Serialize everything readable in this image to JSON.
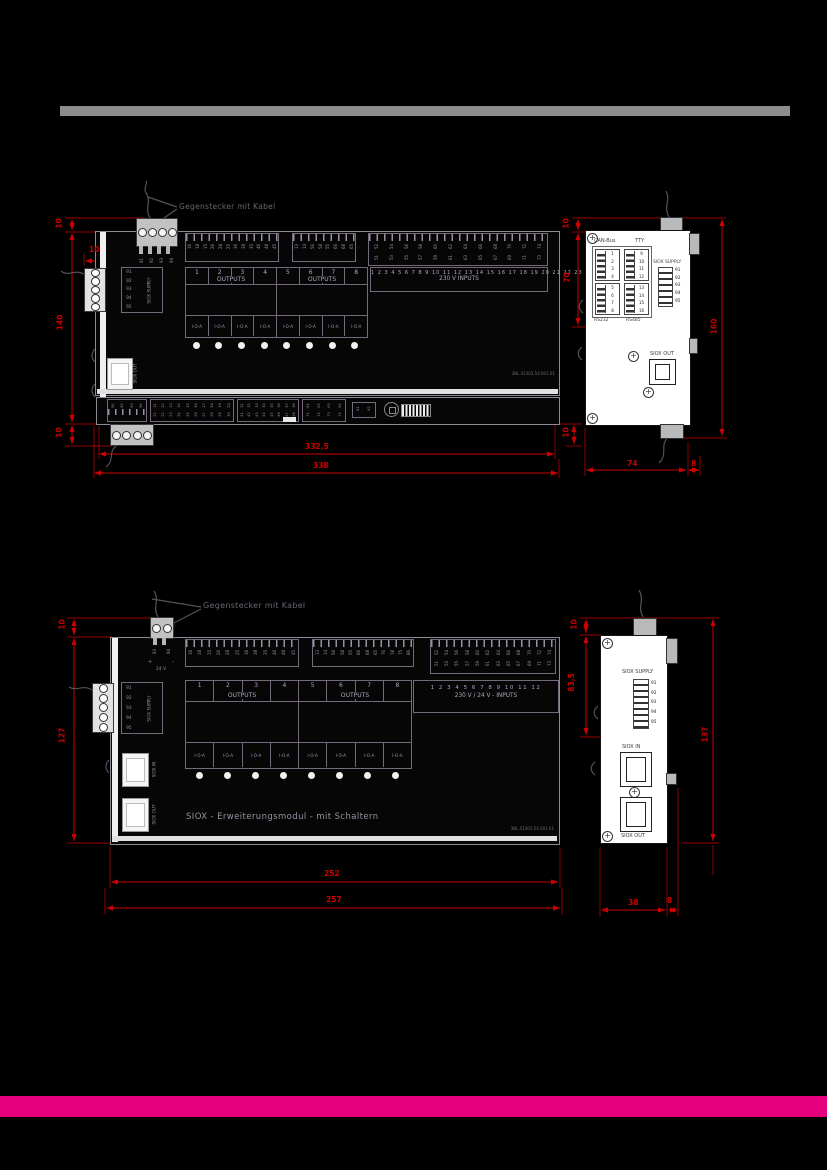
{
  "page": {
    "colors": {
      "background": "#000000",
      "gray_bar": "#8c8c8c",
      "magenta_bar": "#e6007e",
      "dimension_red": "#cc0000"
    }
  },
  "annotation": {
    "label": "Gegenstecker mit Kabel"
  },
  "module1": {
    "front": {
      "top_connector_pins": [
        "91",
        "92",
        "93",
        "94"
      ],
      "strip1_numbers": [
        "16",
        "18",
        "15",
        "26",
        "28",
        "25",
        "36",
        "38",
        "35",
        "46",
        "48",
        "45"
      ],
      "strip2_numbers": [
        "13",
        "14",
        "56",
        "58",
        "55",
        "66",
        "68",
        "65"
      ],
      "strip3_top": [
        "52",
        "54",
        "56",
        "58",
        "60",
        "62",
        "64",
        "66",
        "68",
        "70",
        "72",
        "74"
      ],
      "strip3_bottom": [
        "51",
        "53",
        "55",
        "57",
        "59",
        "61",
        "63",
        "65",
        "67",
        "69",
        "71",
        "73"
      ],
      "outputs1": {
        "numbers": [
          "1",
          "2",
          "3",
          "4"
        ],
        "label": "OUTPUTS",
        "ioa": [
          "I-O-A",
          "I-O-A",
          "I-O-A",
          "I-O-A"
        ]
      },
      "outputs2": {
        "numbers": [
          "5",
          "6",
          "7",
          "8"
        ],
        "label": "OUTPUTS",
        "ioa": [
          "I-O-A",
          "I-O-A",
          "I-O-A",
          "I-O-A"
        ]
      },
      "inputs": {
        "numbers": "1 2 3 4 5 6 7 8 9 10 11 12 13 14 15 16 17 18 19 20 21 22 23",
        "label": "230 V INPUTS"
      },
      "siox_supply": {
        "pins": [
          "91",
          "92",
          "93",
          "94",
          "95"
        ],
        "label": "SIOX SUPPLY"
      },
      "siox_out_label": "SIOX OUT",
      "part_number": "3NL.41303.54.001.01",
      "bottom": {
        "b0": [
          "91",
          "92",
          "93",
          "94"
        ],
        "b1_top": [
          "11",
          "12",
          "13",
          "14",
          "15",
          "16",
          "17",
          "18",
          "19",
          "20"
        ],
        "b1_bottom": [
          "21",
          "22",
          "23",
          "24",
          "25",
          "26",
          "27",
          "28",
          "29",
          "30"
        ],
        "b2_top": [
          "31",
          "32",
          "33",
          "34",
          "35",
          "36",
          "37",
          "38"
        ],
        "b2_bottom": [
          "41",
          "42",
          "43",
          "44",
          "45",
          "46",
          "47",
          "48"
        ],
        "b3_top": [
          "61",
          "62",
          "63",
          "64"
        ],
        "b3_bottom": [
          "71",
          "72",
          "73",
          "74"
        ],
        "b4": [
          "81",
          "82"
        ]
      }
    },
    "side": {
      "canbus_label": "CAN-Bus",
      "tty_label": "TTY",
      "rs232_label": "RS232",
      "rs485_label": "RS485",
      "pins_a": [
        "1",
        "2",
        "3",
        "4"
      ],
      "pins_b": [
        "5",
        "6",
        "7",
        "8"
      ],
      "pins_c": [
        "9",
        "10",
        "11",
        "12"
      ],
      "pins_d": [
        "13",
        "14",
        "15",
        "16"
      ],
      "siox_supply": {
        "label": "SIOX SUPPLY",
        "pins": [
          "91",
          "92",
          "93",
          "94",
          "95"
        ]
      },
      "siox_out_label": "SIOX OUT"
    },
    "dims": {
      "top": "10",
      "conn": "10",
      "height": "140",
      "bottom_left": "10",
      "bottom_right": "10",
      "inner_width": "332,5",
      "outer_width": "338",
      "side_top": "10",
      "side_upper": "70",
      "side_height": "160",
      "side_depth": "74",
      "side_tab": "8"
    }
  },
  "module2": {
    "front": {
      "top_connector": {
        "pins": [
          "93",
          "94"
        ],
        "plus": "+",
        "minus": "-",
        "voltage": "24 V"
      },
      "strip1_numbers": [
        "16",
        "18",
        "15",
        "26",
        "28",
        "25",
        "36",
        "38",
        "35",
        "46",
        "48",
        "45"
      ],
      "strip2_numbers": [
        "13",
        "14",
        "56",
        "58",
        "55",
        "66",
        "68",
        "65",
        "76",
        "78",
        "75",
        "86"
      ],
      "strip3_top": [
        "52",
        "54",
        "56",
        "58",
        "60",
        "62",
        "64",
        "66",
        "68",
        "70",
        "72",
        "74"
      ],
      "strip3_bottom": [
        "51",
        "53",
        "55",
        "57",
        "59",
        "61",
        "63",
        "65",
        "67",
        "69",
        "71",
        "73"
      ],
      "outputs1": {
        "numbers": [
          "1",
          "2",
          "3",
          "4"
        ],
        "label": "OUTPUTS",
        "ioa": [
          "I-O-A",
          "I-O-A",
          "I-O-A",
          "I-O-A"
        ]
      },
      "outputs2": {
        "numbers": [
          "5",
          "6",
          "7",
          "8"
        ],
        "label": "OUTPUTS",
        "ioa": [
          "I-O-A",
          "I-O-A",
          "I-O-A",
          "I-O-A"
        ]
      },
      "inputs": {
        "numbers": "1 2 3 4 5 6 7 8 9 10 11 12",
        "label": "230 V / 24 V - INPUTS"
      },
      "siox_supply": {
        "pins": [
          "91",
          "92",
          "93",
          "94",
          "95"
        ],
        "label": "SIOX SUPPLY"
      },
      "siox_in_label": "SIOX IN",
      "siox_out_label": "SIOX OUT",
      "title": "SIOX - Erweiterungsmodul - mit Schaltern",
      "part_number": "3NL.51303.54.001.01"
    },
    "side": {
      "siox_supply": {
        "label": "SIOX SUPPLY",
        "pins": [
          "91",
          "92",
          "93",
          "94",
          "95"
        ]
      },
      "siox_in_label": "SIOX IN",
      "siox_out_label": "SIOX OUT"
    },
    "dims": {
      "top": "10",
      "height": "127",
      "inner_width": "252",
      "outer_width": "257",
      "side_top": "10",
      "side_upper": "83,5",
      "side_height": "137",
      "side_depth": "38",
      "side_tab": "8"
    }
  }
}
